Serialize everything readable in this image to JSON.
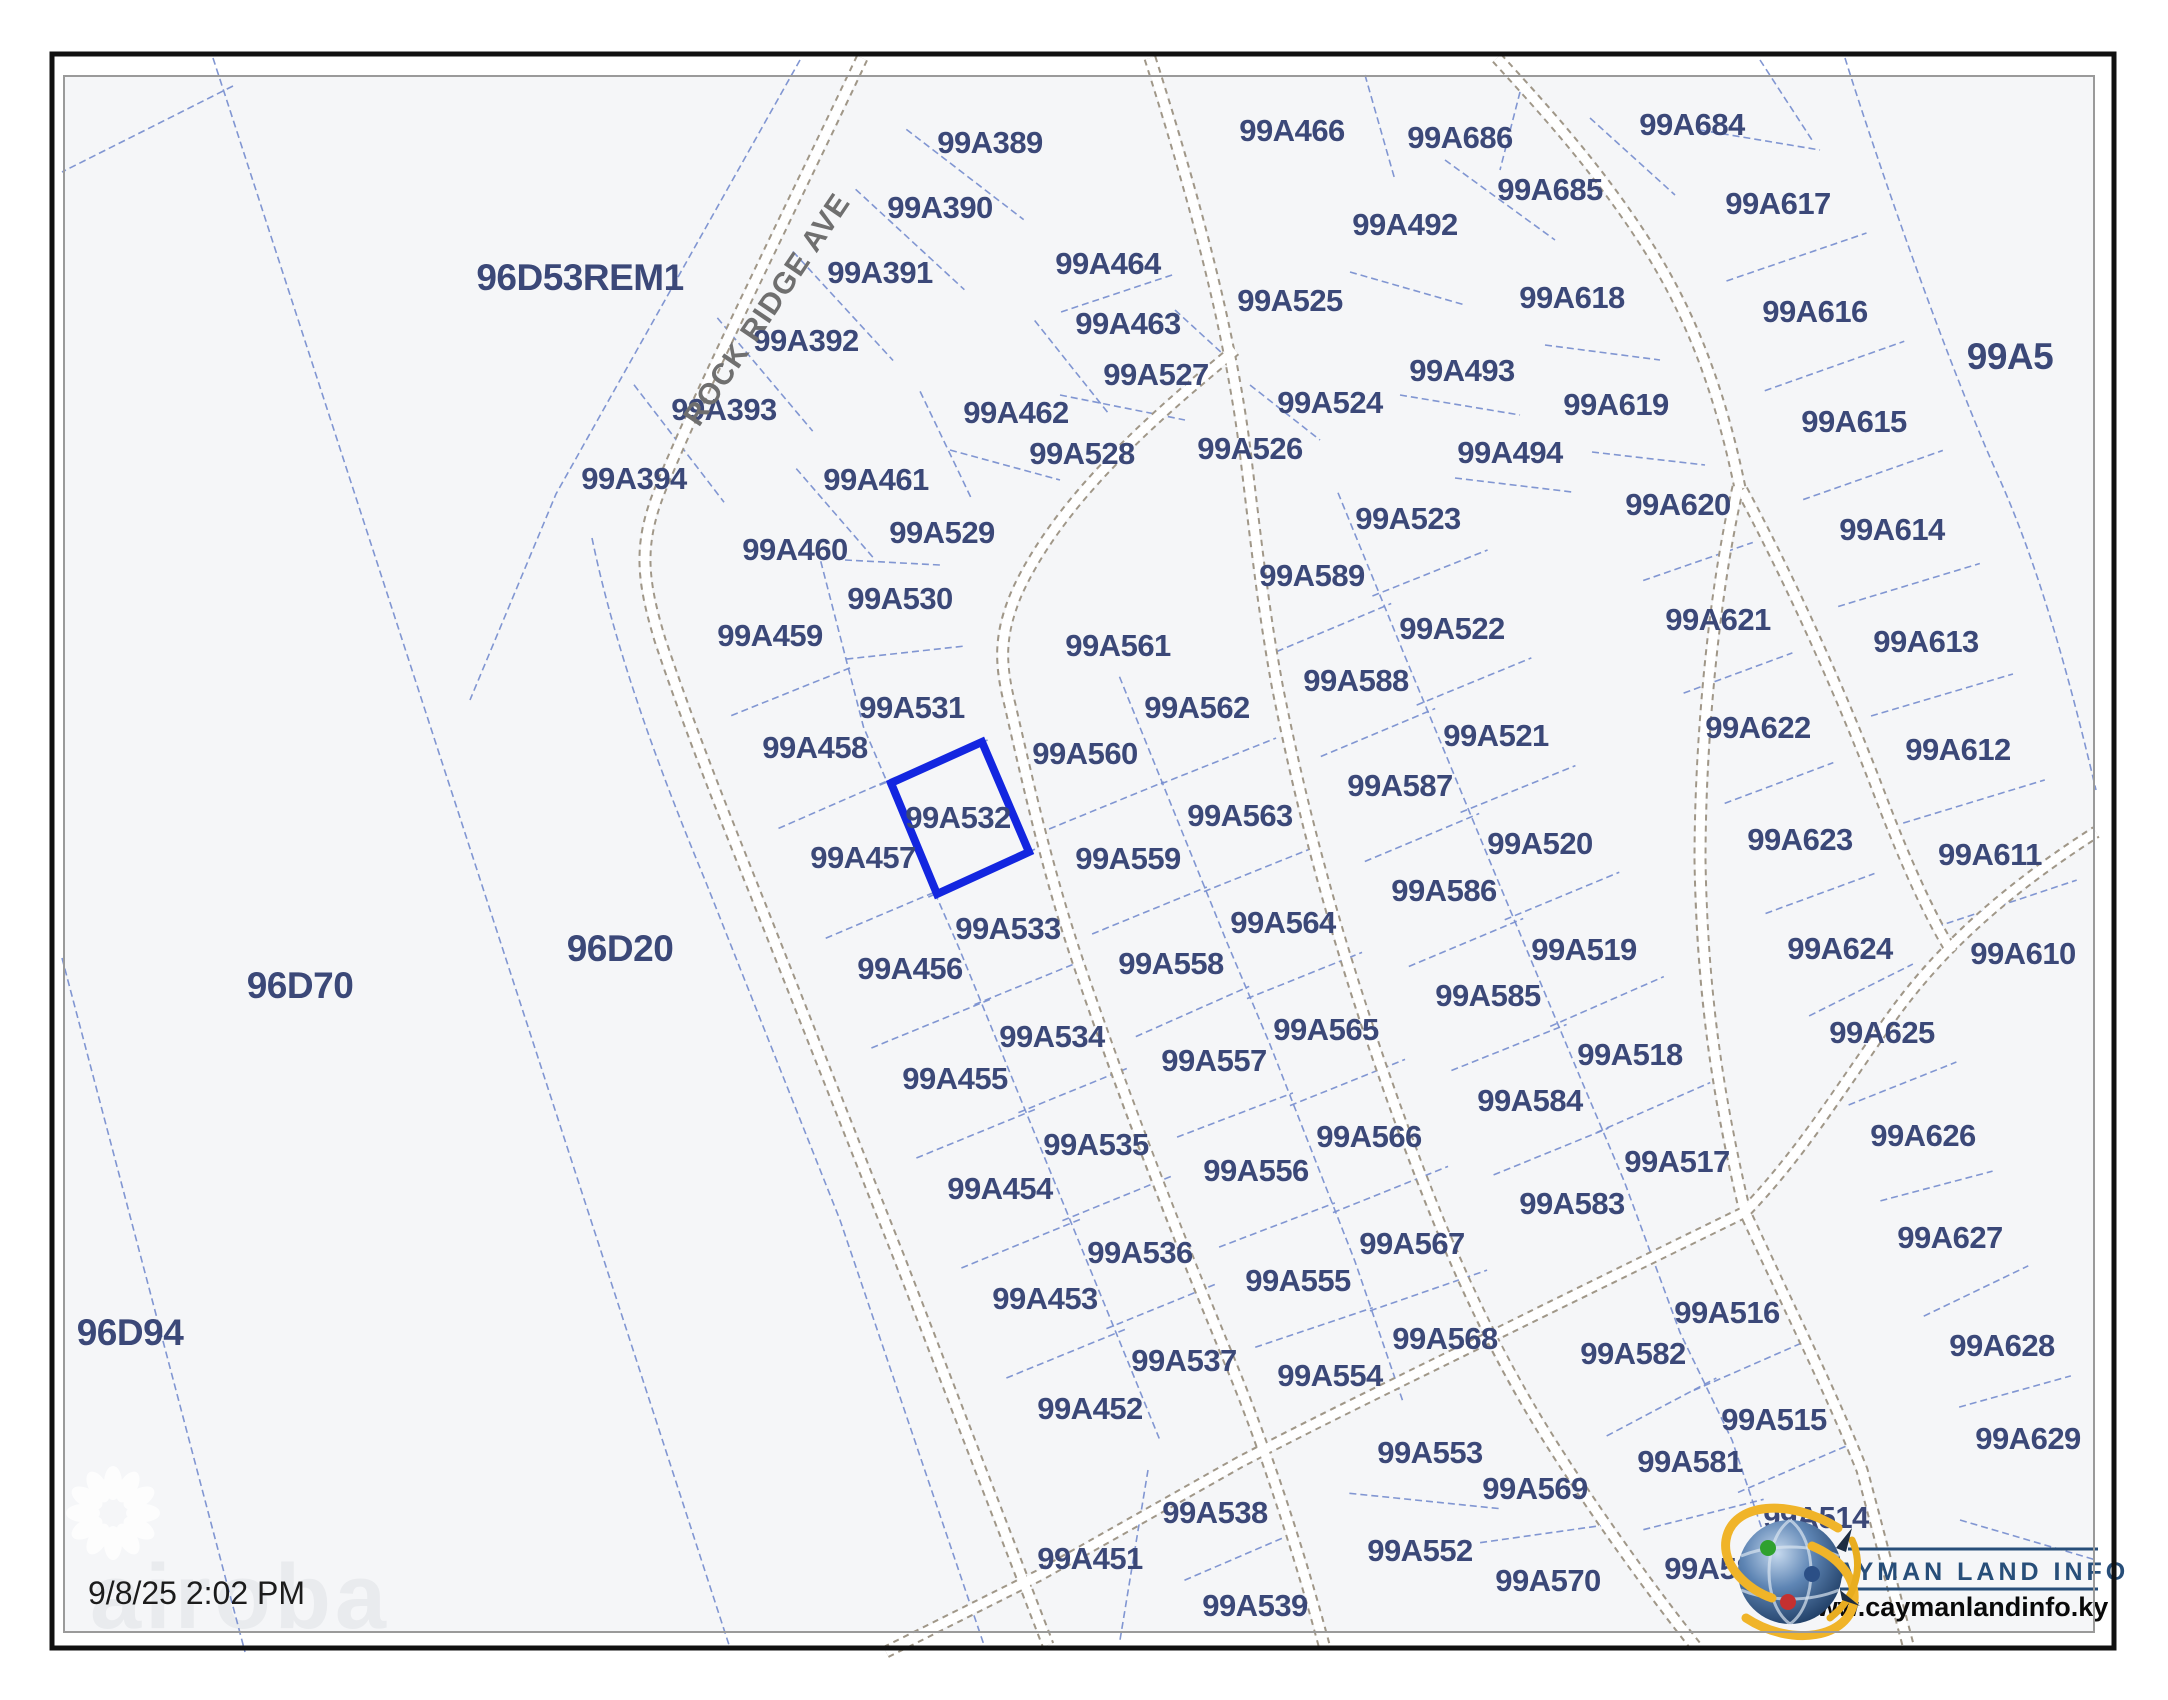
{
  "map": {
    "timestamp": "9/8/25 2:02 PM",
    "street_name": "ROCK RIDGE AVE",
    "highlighted_parcel": "99A532",
    "watermark_text": "airoba",
    "logo": {
      "name": "CAYMAN LAND INFO",
      "url": "www.caymanlandinfo.ky"
    },
    "colors": {
      "parcel_line": "#7a90d0",
      "parcel_label": "#3b4878",
      "highlight": "#1326e0",
      "road_edge": "#a09788",
      "logo_navy": "#274e79",
      "map_bg": "#f5f6f8"
    },
    "parcels": [
      {
        "id": "96D53REM1",
        "x": 580,
        "y": 277,
        "big": true
      },
      {
        "id": "96D70",
        "x": 300,
        "y": 985,
        "big": true
      },
      {
        "id": "96D94",
        "x": 130,
        "y": 1332,
        "big": true
      },
      {
        "id": "96D20",
        "x": 620,
        "y": 948,
        "big": true
      },
      {
        "id": "99A5",
        "x": 2010,
        "y": 356,
        "big": true
      },
      {
        "id": "99A389",
        "x": 990,
        "y": 142
      },
      {
        "id": "99A390",
        "x": 940,
        "y": 207
      },
      {
        "id": "99A391",
        "x": 880,
        "y": 272
      },
      {
        "id": "99A392",
        "x": 806,
        "y": 340
      },
      {
        "id": "99A393",
        "x": 724,
        "y": 409
      },
      {
        "id": "99A394",
        "x": 634,
        "y": 478
      },
      {
        "id": "99A464",
        "x": 1108,
        "y": 263
      },
      {
        "id": "99A463",
        "x": 1128,
        "y": 323
      },
      {
        "id": "99A462",
        "x": 1016,
        "y": 412
      },
      {
        "id": "99A461",
        "x": 876,
        "y": 479
      },
      {
        "id": "99A460",
        "x": 795,
        "y": 549
      },
      {
        "id": "99A466",
        "x": 1292,
        "y": 130
      },
      {
        "id": "99A686",
        "x": 1460,
        "y": 137
      },
      {
        "id": "99A684",
        "x": 1692,
        "y": 124
      },
      {
        "id": "99A685",
        "x": 1550,
        "y": 189
      },
      {
        "id": "99A492",
        "x": 1405,
        "y": 224
      },
      {
        "id": "99A493",
        "x": 1462,
        "y": 370
      },
      {
        "id": "99A494",
        "x": 1510,
        "y": 452
      },
      {
        "id": "99A525",
        "x": 1290,
        "y": 300
      },
      {
        "id": "99A527",
        "x": 1156,
        "y": 374
      },
      {
        "id": "99A526",
        "x": 1250,
        "y": 448
      },
      {
        "id": "99A528",
        "x": 1082,
        "y": 453
      },
      {
        "id": "99A524",
        "x": 1330,
        "y": 402
      },
      {
        "id": "99A617",
        "x": 1778,
        "y": 203
      },
      {
        "id": "99A618",
        "x": 1572,
        "y": 297
      },
      {
        "id": "99A616",
        "x": 1815,
        "y": 311
      },
      {
        "id": "99A615",
        "x": 1854,
        "y": 421
      },
      {
        "id": "99A614",
        "x": 1892,
        "y": 529
      },
      {
        "id": "99A613",
        "x": 1926,
        "y": 641
      },
      {
        "id": "99A612",
        "x": 1958,
        "y": 749
      },
      {
        "id": "99A611",
        "x": 1990,
        "y": 854
      },
      {
        "id": "99A610",
        "x": 2023,
        "y": 953
      },
      {
        "id": "99A619",
        "x": 1616,
        "y": 404
      },
      {
        "id": "99A620",
        "x": 1678,
        "y": 504
      },
      {
        "id": "99A621",
        "x": 1718,
        "y": 619
      },
      {
        "id": "99A622",
        "x": 1758,
        "y": 727
      },
      {
        "id": "99A623",
        "x": 1800,
        "y": 839
      },
      {
        "id": "99A624",
        "x": 1840,
        "y": 948
      },
      {
        "id": "99A625",
        "x": 1882,
        "y": 1032
      },
      {
        "id": "99A626",
        "x": 1923,
        "y": 1135
      },
      {
        "id": "99A627",
        "x": 1950,
        "y": 1237
      },
      {
        "id": "99A628",
        "x": 2002,
        "y": 1345
      },
      {
        "id": "99A629",
        "x": 2028,
        "y": 1438
      },
      {
        "id": "99A529",
        "x": 942,
        "y": 532
      },
      {
        "id": "99A530",
        "x": 900,
        "y": 598
      },
      {
        "id": "99A531",
        "x": 912,
        "y": 707
      },
      {
        "id": "99A532",
        "x": 958,
        "y": 817
      },
      {
        "id": "99A533",
        "x": 1008,
        "y": 928
      },
      {
        "id": "99A534",
        "x": 1052,
        "y": 1036
      },
      {
        "id": "99A535",
        "x": 1096,
        "y": 1144
      },
      {
        "id": "99A536",
        "x": 1140,
        "y": 1252
      },
      {
        "id": "99A537",
        "x": 1184,
        "y": 1360
      },
      {
        "id": "99A538",
        "x": 1215,
        "y": 1512
      },
      {
        "id": "99A539",
        "x": 1255,
        "y": 1605
      },
      {
        "id": "99A459",
        "x": 770,
        "y": 635
      },
      {
        "id": "99A458",
        "x": 815,
        "y": 747
      },
      {
        "id": "99A457",
        "x": 863,
        "y": 857
      },
      {
        "id": "99A456",
        "x": 910,
        "y": 968
      },
      {
        "id": "99A455",
        "x": 955,
        "y": 1078
      },
      {
        "id": "99A454",
        "x": 1000,
        "y": 1188
      },
      {
        "id": "99A453",
        "x": 1045,
        "y": 1298
      },
      {
        "id": "99A452",
        "x": 1090,
        "y": 1408
      },
      {
        "id": "99A451",
        "x": 1090,
        "y": 1558
      },
      {
        "id": "99A561",
        "x": 1118,
        "y": 645
      },
      {
        "id": "99A560",
        "x": 1085,
        "y": 753
      },
      {
        "id": "99A559",
        "x": 1128,
        "y": 858
      },
      {
        "id": "99A558",
        "x": 1171,
        "y": 963
      },
      {
        "id": "99A557",
        "x": 1214,
        "y": 1060
      },
      {
        "id": "99A556",
        "x": 1256,
        "y": 1170
      },
      {
        "id": "99A555",
        "x": 1298,
        "y": 1280
      },
      {
        "id": "99A554",
        "x": 1330,
        "y": 1375
      },
      {
        "id": "99A553",
        "x": 1430,
        "y": 1452
      },
      {
        "id": "99A552",
        "x": 1420,
        "y": 1550
      },
      {
        "id": "99A562",
        "x": 1197,
        "y": 707
      },
      {
        "id": "99A563",
        "x": 1240,
        "y": 815
      },
      {
        "id": "99A564",
        "x": 1283,
        "y": 922
      },
      {
        "id": "99A565",
        "x": 1326,
        "y": 1029
      },
      {
        "id": "99A566",
        "x": 1369,
        "y": 1136
      },
      {
        "id": "99A567",
        "x": 1412,
        "y": 1243
      },
      {
        "id": "99A568",
        "x": 1445,
        "y": 1338
      },
      {
        "id": "99A569",
        "x": 1535,
        "y": 1488
      },
      {
        "id": "99A570",
        "x": 1548,
        "y": 1580
      },
      {
        "id": "99A589",
        "x": 1312,
        "y": 575
      },
      {
        "id": "99A588",
        "x": 1356,
        "y": 680
      },
      {
        "id": "99A587",
        "x": 1400,
        "y": 785
      },
      {
        "id": "99A586",
        "x": 1444,
        "y": 890
      },
      {
        "id": "99A585",
        "x": 1488,
        "y": 995
      },
      {
        "id": "99A584",
        "x": 1530,
        "y": 1100
      },
      {
        "id": "99A583",
        "x": 1572,
        "y": 1203
      },
      {
        "id": "99A582",
        "x": 1633,
        "y": 1353
      },
      {
        "id": "99A581",
        "x": 1690,
        "y": 1461
      },
      {
        "id": "99A580",
        "x": 1717,
        "y": 1568
      },
      {
        "id": "99A523",
        "x": 1408,
        "y": 518
      },
      {
        "id": "99A522",
        "x": 1452,
        "y": 628
      },
      {
        "id": "99A521",
        "x": 1496,
        "y": 735
      },
      {
        "id": "99A520",
        "x": 1540,
        "y": 843
      },
      {
        "id": "99A519",
        "x": 1584,
        "y": 949
      },
      {
        "id": "99A518",
        "x": 1630,
        "y": 1054
      },
      {
        "id": "99A517",
        "x": 1677,
        "y": 1161
      },
      {
        "id": "99A516",
        "x": 1727,
        "y": 1312
      },
      {
        "id": "99A515",
        "x": 1774,
        "y": 1419
      },
      {
        "id": "99A514",
        "x": 1816,
        "y": 1517
      }
    ]
  }
}
